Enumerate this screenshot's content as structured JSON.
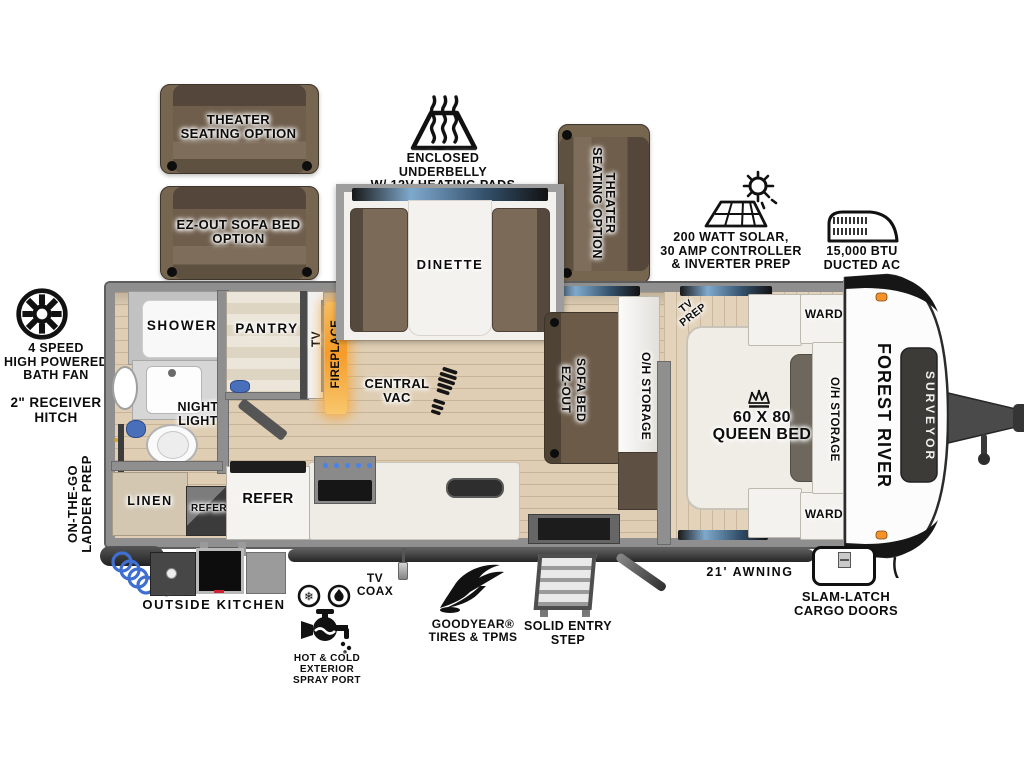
{
  "brand": {
    "make": "FOREST RIVER",
    "model": "SURVEYOR"
  },
  "options": {
    "theater_top": "THEATER\nSEATING OPTION",
    "ezout": "EZ-OUT SOFA BED\nOPTION",
    "theater_right": "THEATER\nSEATING OPTION"
  },
  "callouts": {
    "underbelly": "ENCLOSED UNDERBELLY\nW/ 12V HEATING PADS",
    "solar": "200 WATT SOLAR,\n30 AMP CONTROLLER\n& INVERTER PREP",
    "ac": "15,000 BTU\nDUCTED AC",
    "bath_fan": "4 SPEED\nHIGH POWERED\nBATH FAN",
    "receiver_hitch": "2\" RECEIVER\nHITCH",
    "ladder_prep": "ON-THE-GO\nLADDER PREP",
    "outside_kitchen": "OUTSIDE KITCHEN",
    "spray_port": "HOT & COLD EXTERIOR\nSPRAY PORT",
    "tv_coax": "TV\nCOAX",
    "goodyear": "GOODYEAR®\nTIRES & TPMS",
    "entry_step": "SOLID ENTRY\nSTEP",
    "awning": "21' AWNING",
    "cargo_doors": "SLAM-LATCH\nCARGO DOORS"
  },
  "interior": {
    "shower": "SHOWER",
    "night_light": "NIGHT\nLIGHT",
    "linen": "LINEN",
    "refer_small": "REFER",
    "refer_main": "REFER",
    "pantry": "PANTRY",
    "tv": "TV",
    "fireplace": "FIREPLACE",
    "central_vac": "CENTRAL\nVAC",
    "dinette": "DINETTE",
    "sofa_bed": "EZ-OUT\nSOFA BED",
    "oh_storage_living": "O/H STORAGE",
    "tv_prep": "TV\nPREP",
    "queen_bed": "60 X 80\nQUEEN BED",
    "ward_top": "WARD",
    "ward_bottom": "WARD",
    "oh_storage_bedroom": "O/H STORAGE"
  },
  "icons": {
    "snowflake": "❄"
  },
  "colors": {
    "floor_tan": "#dfceb4",
    "wall_gray": "#8f8f8f",
    "sofa_brown": "#6f5e4c",
    "fireplace_glow": "#f6a33a",
    "window_blue": "#7fa9cc",
    "hose_blue": "#3f6fd1",
    "marker_orange": "#f49129"
  }
}
